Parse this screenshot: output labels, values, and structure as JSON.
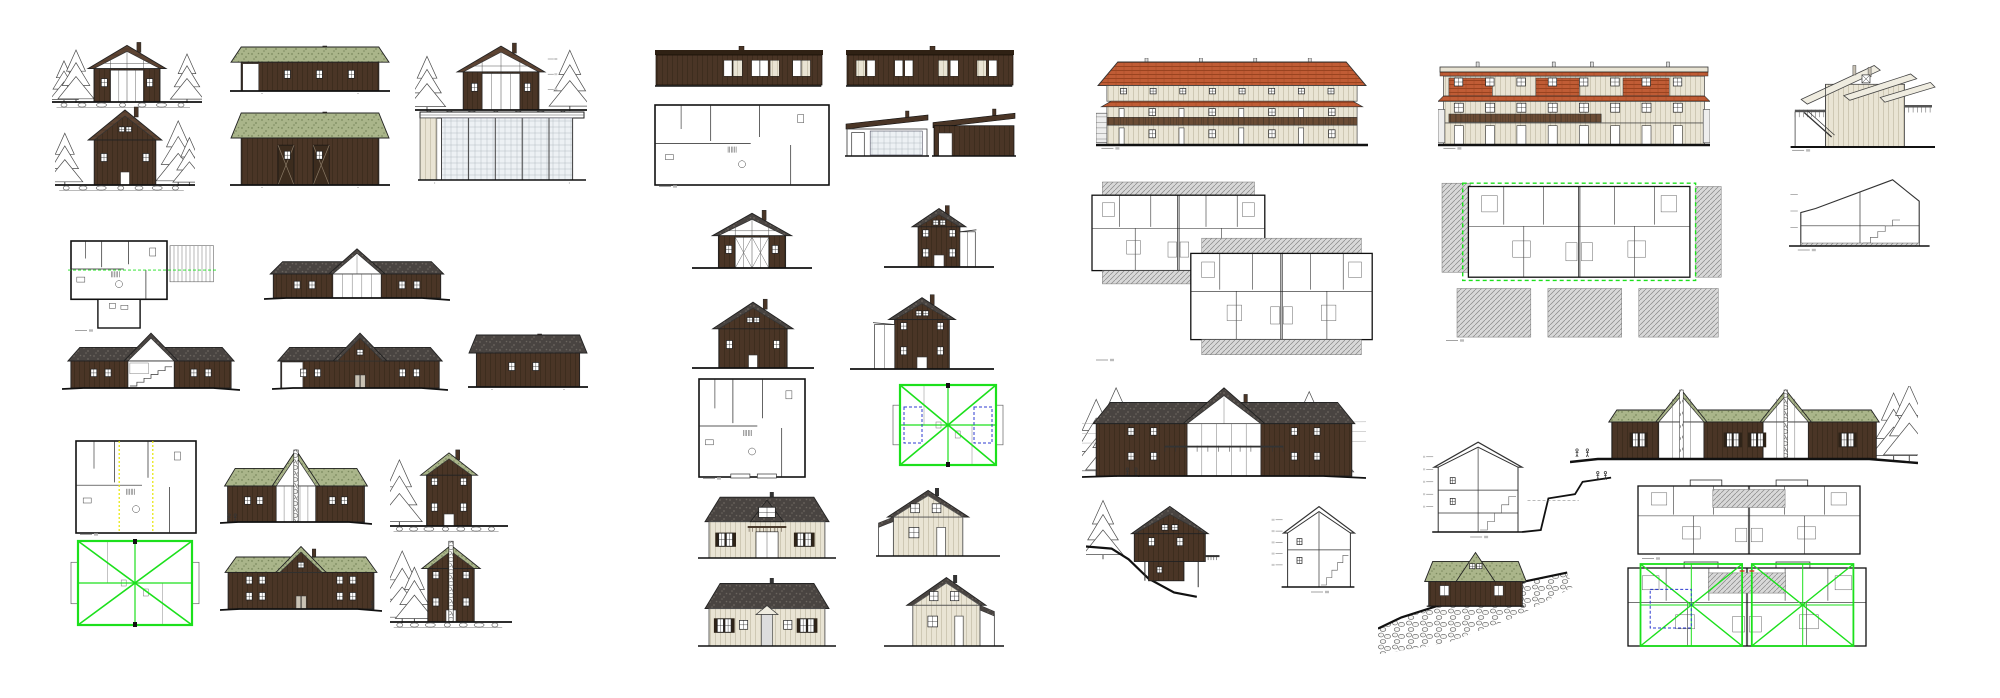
{
  "canvas": {
    "width": 2000,
    "height": 698,
    "background": "#ffffff"
  },
  "palette": {
    "woodDark": "#4a3526",
    "woodDarkLine": "#392a1c",
    "woodMid": "#6b4c35",
    "woodMidLine": "#57402c",
    "cream": "#e9e4d4",
    "creamLine": "#c8c1ac",
    "roofGreen": "#aab58a",
    "roofGreenDot": "#7c8a5f",
    "roofDark": "#494441",
    "roofDarkDot": "#6b655e",
    "roofBrown": "#5d4433",
    "roofBrownLine": "#4a3425",
    "tile": "#c05c35",
    "tileLine": "#99431f",
    "line": "#1a1a1a",
    "gray": "#555555",
    "green": "#1ce01c",
    "yellow": "#e6e600",
    "blue": "#2d3bd0",
    "red": "#cc3322",
    "glass": "#edf1f4",
    "deck": "#999999",
    "white": "#ffffff"
  },
  "groups": [
    {
      "name": "cabin-set-left",
      "items": [
        {
          "name": "cabin-a-front-elevation",
          "type": "gable-front",
          "x": 52,
          "y": 40,
          "w": 150,
          "h": 68,
          "f": {
            "trees": [
              [
                0.08,
                0.62
              ],
              [
                0.16,
                0.78
              ],
              [
                0.9,
                0.72
              ]
            ],
            "glazed": true,
            "roof": "roofBrown",
            "rocks": true,
            "chimney": true
          }
        },
        {
          "name": "cabin-a-side-elevation",
          "type": "side-elevation",
          "x": 230,
          "y": 44,
          "w": 160,
          "h": 52,
          "f": {
            "roof": "roofGreen",
            "whiteDoor": true,
            "win": 3
          }
        },
        {
          "name": "cabin-a-front-elevation-annotated",
          "type": "gable-front",
          "x": 415,
          "y": 40,
          "w": 172,
          "h": 76,
          "f": {
            "trees": [
              [
                0.07,
                0.72
              ],
              [
                0.9,
                0.8
              ]
            ],
            "glazed": true,
            "roof": "roofBrown",
            "rocks": true,
            "dims": true,
            "chimney": true
          }
        },
        {
          "name": "cabin-b-front-elevation",
          "type": "gable-front",
          "x": 55,
          "y": 103,
          "w": 140,
          "h": 88,
          "f": {
            "trees": [
              [
                0.07,
                0.6
              ],
              [
                0.88,
                0.74
              ],
              [
                0.96,
                0.55
              ]
            ],
            "roof": "roofBrown",
            "rocks": true,
            "chimney": true,
            "gableWin": true
          }
        },
        {
          "name": "cabin-b-side-elevation",
          "type": "side-elevation",
          "x": 230,
          "y": 110,
          "w": 160,
          "h": 80,
          "f": {
            "roof": "roofGreen",
            "barn": true,
            "win": 2
          }
        },
        {
          "name": "carport-glass-elevation",
          "type": "pavilion",
          "x": 418,
          "y": 106,
          "w": 168,
          "h": 80,
          "f": {}
        },
        {
          "name": "cabin-a-floor-plan",
          "type": "floor-plan",
          "x": 68,
          "y": 238,
          "w": 150,
          "h": 94,
          "f": {
            "deck": "right",
            "greenLine": true,
            "ext": true,
            "mark": true
          }
        },
        {
          "name": "lodge-a-front-elevation",
          "type": "center-gable",
          "x": 264,
          "y": 246,
          "w": 186,
          "h": 56,
          "f": {
            "roof": "roofDark",
            "glazed": true
          }
        },
        {
          "name": "lodge-a-section-elevation",
          "type": "center-gable",
          "x": 62,
          "y": 330,
          "w": 178,
          "h": 62,
          "f": {
            "roof": "roofDark",
            "open": true
          }
        },
        {
          "name": "lodge-a-rear-elevation",
          "type": "center-gable",
          "x": 272,
          "y": 330,
          "w": 176,
          "h": 62,
          "f": {
            "roof": "roofDark",
            "door": true,
            "gableWin": true,
            "openBay": "left"
          }
        },
        {
          "name": "garage-side-elevation",
          "type": "side-elevation",
          "x": 468,
          "y": 332,
          "w": 120,
          "h": 60,
          "f": {
            "roof": "roofDark",
            "win": 2
          }
        },
        {
          "name": "chalet-a-floor-plan",
          "type": "floor-plan",
          "x": 73,
          "y": 438,
          "w": 126,
          "h": 98,
          "f": {
            "hl": "yellow",
            "mark": true
          }
        },
        {
          "name": "chalet-a-front-elevation",
          "type": "center-gable",
          "x": 220,
          "y": 446,
          "w": 152,
          "h": 80,
          "f": {
            "roof": "roofGreen",
            "glazed": true,
            "stoneChim": true,
            "fig": [
              0.06,
              0.1
            ]
          }
        },
        {
          "name": "chalet-a-hillside-elevation",
          "type": "gable-front",
          "x": 390,
          "y": 446,
          "w": 118,
          "h": 86,
          "f": {
            "roof": "roofGreen",
            "stories": 2,
            "rocks": true,
            "trees": [
              [
                0.08,
                0.78
              ]
            ],
            "narrow": true,
            "chimney": true
          }
        },
        {
          "name": "chalet-a-roof-plan-highlighted",
          "type": "roof-plan-green",
          "x": 66,
          "y": 536,
          "w": 138,
          "h": 94,
          "f": {}
        },
        {
          "name": "chalet-a-rear-elevation",
          "type": "center-gable",
          "x": 220,
          "y": 543,
          "w": 162,
          "h": 70,
          "f": {
            "roof": "roofGreen",
            "stories": 2,
            "door": true,
            "gableWin": true,
            "chimney": true,
            "fig": [
              0.94
            ]
          }
        },
        {
          "name": "chalet-a-hillside-rear-elevation",
          "type": "gable-front",
          "x": 390,
          "y": 538,
          "w": 122,
          "h": 90,
          "f": {
            "roof": "roofGreen",
            "stories": 2,
            "rocks": true,
            "trees": [
              [
                0.1,
                0.8
              ],
              [
                0.2,
                0.62
              ]
            ],
            "stoneChim": true,
            "narrow": true
          }
        }
      ]
    },
    {
      "name": "modern-cabin-set",
      "items": [
        {
          "name": "modern-cabin-front-elevation",
          "type": "flat-modern",
          "x": 655,
          "y": 46,
          "w": 168,
          "h": 42,
          "f": {
            "alt": 1
          }
        },
        {
          "name": "modern-cabin-rear-elevation",
          "type": "flat-modern",
          "x": 846,
          "y": 46,
          "w": 168,
          "h": 42,
          "f": {
            "alt": 2
          }
        },
        {
          "name": "modern-cabin-floor-plan",
          "type": "floor-plan",
          "x": 652,
          "y": 102,
          "w": 180,
          "h": 86,
          "f": {
            "deckCorners": true,
            "mark": true
          }
        },
        {
          "name": "annex-glass-elevation",
          "type": "hut-mono",
          "x": 845,
          "y": 110,
          "w": 84,
          "h": 50,
          "f": {
            "glass": true
          }
        },
        {
          "name": "annex-side-elevation",
          "type": "hut-mono",
          "x": 932,
          "y": 108,
          "w": 84,
          "h": 52,
          "f": {}
        },
        {
          "name": "cabin-c-front-elevation",
          "type": "gable-front",
          "x": 692,
          "y": 208,
          "w": 120,
          "h": 66,
          "f": {
            "glazed": true,
            "roof": "roofDark",
            "xdoor": true,
            "wide": true,
            "chimney": true
          }
        },
        {
          "name": "cabin-c-end-elevation",
          "type": "gable-front",
          "x": 884,
          "y": 203,
          "w": 110,
          "h": 70,
          "f": {
            "roof": "roofDark",
            "narrow": true,
            "gableWin": true,
            "wingRight": true,
            "stories": 2,
            "chimney": true
          }
        },
        {
          "name": "cabin-c-rear-elevation",
          "type": "gable-front",
          "x": 692,
          "y": 296,
          "w": 122,
          "h": 78,
          "f": {
            "roof": "roofDark",
            "wide": true,
            "gableWin": true,
            "chimney": true
          }
        },
        {
          "name": "cabin-c-end-elevation-2",
          "type": "gable-front",
          "x": 850,
          "y": 291,
          "w": 144,
          "h": 84,
          "f": {
            "roof": "roofDark",
            "narrow": true,
            "gableWin": true,
            "wingLeft": true,
            "stories": 2,
            "chimney": true
          }
        },
        {
          "name": "cabin-c-ground-floor-plan",
          "type": "floor-plan",
          "x": 696,
          "y": 376,
          "w": 112,
          "h": 104,
          "f": {
            "porch": true,
            "mark": true
          }
        },
        {
          "name": "cabin-c-upper-floor-plan-highlighted",
          "type": "roof-plan-green",
          "x": 888,
          "y": 380,
          "w": 120,
          "h": 90,
          "f": {
            "blue": true
          }
        },
        {
          "name": "house-a-front-elevation",
          "type": "cream-house",
          "x": 698,
          "y": 490,
          "w": 138,
          "h": 72,
          "f": {
            "view": "front"
          }
        },
        {
          "name": "house-a-end-elevation",
          "type": "cream-house",
          "x": 876,
          "y": 486,
          "w": 124,
          "h": 74,
          "f": {
            "view": "side"
          }
        },
        {
          "name": "house-a-rear-elevation",
          "type": "cream-house",
          "x": 698,
          "y": 576,
          "w": 138,
          "h": 74,
          "f": {
            "view": "rear"
          }
        },
        {
          "name": "house-a-end-elevation-2",
          "type": "cream-house",
          "x": 884,
          "y": 573,
          "w": 120,
          "h": 77,
          "f": {
            "view": "side2"
          }
        }
      ]
    },
    {
      "name": "rowhouse-set",
      "items": [
        {
          "name": "rowhouse-front-elevation",
          "type": "terraced-hip",
          "x": 1096,
          "y": 58,
          "w": 272,
          "h": 92,
          "f": {
            "caption": true
          }
        },
        {
          "name": "rowhouse-floor-plans",
          "type": "duplex-overlap",
          "x": 1090,
          "y": 180,
          "w": 288,
          "h": 182,
          "f": {
            "mark": true
          }
        },
        {
          "name": "chalet-b-front-elevation",
          "type": "center-gable",
          "x": 1082,
          "y": 383,
          "w": 284,
          "h": 97,
          "f": {
            "roof": "roofDark",
            "stories": 2,
            "glazed": true,
            "balcony": true,
            "contours": true,
            "trees": [
              [
                0.05,
                0.8
              ],
              [
                0.12,
                0.92
              ],
              [
                0.2,
                0.72
              ],
              [
                0.8,
                0.88
              ],
              [
                0.88,
                0.66
              ]
            ],
            "fig": [
              0.16,
              0.19
            ],
            "chimney": true
          }
        },
        {
          "name": "chalet-b-hillside-elevation",
          "type": "chalet-slope",
          "x": 1086,
          "y": 493,
          "w": 142,
          "h": 107,
          "f": {}
        },
        {
          "name": "chalet-b-section",
          "type": "section-gable",
          "x": 1270,
          "y": 501,
          "w": 98,
          "h": 94,
          "f": {
            "caption": true
          }
        },
        {
          "name": "chalet-b-section-2",
          "type": "section-gable",
          "x": 1423,
          "y": 436,
          "w": 190,
          "h": 104,
          "f": {
            "tall": true,
            "caption": true,
            "fig": [
              0.92,
              0.96
            ]
          }
        },
        {
          "name": "cabin-d-stone-slope-elevation",
          "type": "cabin-stone",
          "x": 1378,
          "y": 548,
          "w": 195,
          "h": 112,
          "f": {}
        }
      ]
    },
    {
      "name": "right-set",
      "items": [
        {
          "name": "rowhouse-rear-elevation",
          "type": "terraced-flat",
          "x": 1438,
          "y": 60,
          "w": 272,
          "h": 90,
          "f": {
            "caption": true
          }
        },
        {
          "name": "rowhouse-floor-plan-highlighted",
          "type": "duplex-green",
          "x": 1440,
          "y": 180,
          "w": 284,
          "h": 162,
          "f": {
            "mark": true
          }
        },
        {
          "name": "lofthouse-elevation",
          "type": "tall-mono",
          "x": 1786,
          "y": 58,
          "w": 152,
          "h": 94,
          "f": {
            "caption": true
          }
        },
        {
          "name": "lofthouse-section",
          "type": "section-mono",
          "x": 1786,
          "y": 170,
          "w": 148,
          "h": 82,
          "f": {
            "caption": true
          }
        },
        {
          "name": "duplex-lodge-front-elevation",
          "type": "lodge-twin",
          "x": 1570,
          "y": 386,
          "w": 348,
          "h": 80,
          "f": {
            "fig": [
              0.02,
              0.05
            ],
            "trees": [
              [
                0.93,
                0.85
              ],
              [
                0.975,
                0.95
              ]
            ]
          }
        },
        {
          "name": "duplex-lodge-floor-plan",
          "type": "duplex-single",
          "x": 1636,
          "y": 478,
          "w": 226,
          "h": 82,
          "f": {
            "mark": true
          }
        },
        {
          "name": "duplex-lodge-roof-plan-highlighted",
          "type": "duplex-green-x",
          "x": 1626,
          "y": 560,
          "w": 242,
          "h": 92,
          "f": {}
        }
      ]
    }
  ]
}
